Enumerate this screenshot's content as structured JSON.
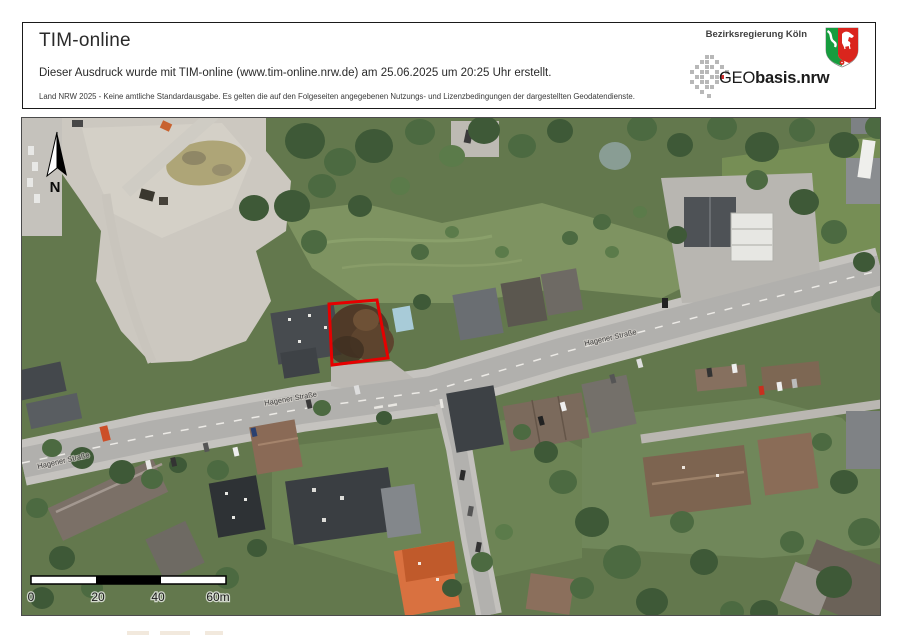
{
  "header": {
    "title": "TIM-online",
    "line1": "Dieser Ausdruck wurde mit TIM-online (www.tim-online.nrw.de) am 25.06.2025 um 20:25 Uhr erstellt.",
    "line2": "Land NRW 2025 - Keine amtliche Standardausgabe. Es gelten die auf den Folgeseiten angegebenen Nutzungs- und Lizenzbedingungen der dargestellten Geodatendienste.",
    "agency": "Bezirksregierung Köln",
    "logo_geo": "GEO",
    "logo_basis": "basis.nrw"
  },
  "map": {
    "north_label": "N",
    "street_label": "Hagener Straße",
    "scale": {
      "ticks": [
        "0",
        "20",
        "40",
        "60m"
      ]
    }
  },
  "colors": {
    "parcel_red": "#e60000",
    "header_border": "#1a1a1a",
    "road_gray": "#b1b0ad",
    "vegetation_green": "#63784d",
    "gravel": "#ccc8c0",
    "roof_dark": "#3f4347",
    "roof_brown": "#8a6c57",
    "roof_orange": "#d97140",
    "nrw_green": "#169c3e",
    "nrw_red": "#da251d",
    "logo_gray": "#b8b8b8"
  }
}
